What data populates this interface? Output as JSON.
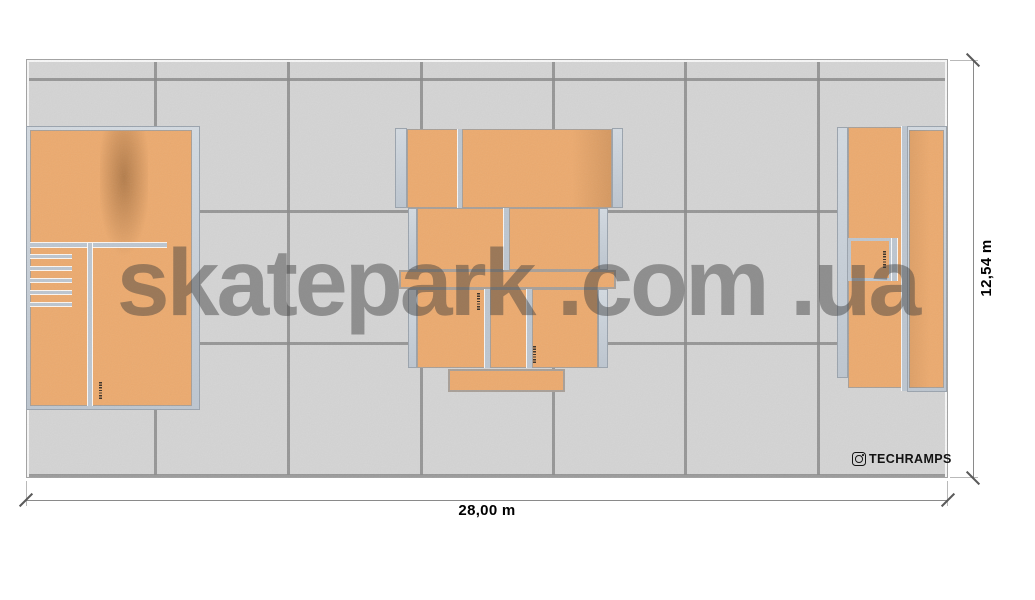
{
  "watermark": {
    "text": "skatepark .com .ua"
  },
  "dimensions": {
    "width_label": "28,00 m",
    "height_label": "12,54 m"
  },
  "branding": {
    "label": "TECHRAMPS",
    "icon": "instagram-badge-icon"
  },
  "colors": {
    "background": "#ffffff",
    "floor": "#d4d4d4",
    "grid_line": "#8b8b8b",
    "wood": "#ecaa6e",
    "frame": "#bdc6d0",
    "frame_edge": "#9aa3ad",
    "watermark": "rgba(60,60,60,0.45)",
    "dimension_line": "#8a8a8a",
    "text": "#000000"
  }
}
